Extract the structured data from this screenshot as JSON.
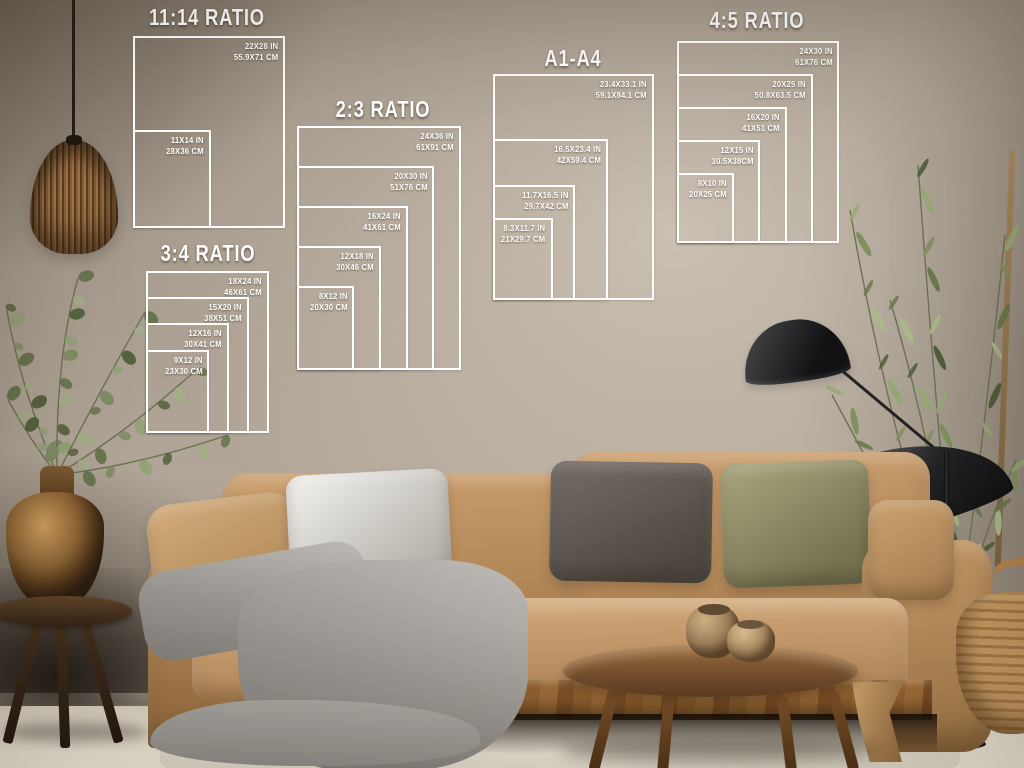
{
  "panels": [
    {
      "id": "ratio-11-14",
      "title": "11:14 RATIO",
      "sizes": [
        {
          "in_label": "22X28 IN",
          "cm_label": "55.9X71 CM",
          "w_in": 22,
          "h_in": 28
        },
        {
          "in_label": "11X14 IN",
          "cm_label": "28X36 CM",
          "w_in": 11,
          "h_in": 14
        }
      ]
    },
    {
      "id": "ratio-2-3",
      "title": "2:3 RATIO",
      "sizes": [
        {
          "in_label": "24X36 IN",
          "cm_label": "61X91 CM",
          "w_in": 24,
          "h_in": 36
        },
        {
          "in_label": "20X30 IN",
          "cm_label": "51X76 CM",
          "w_in": 20,
          "h_in": 30
        },
        {
          "in_label": "16X24 IN",
          "cm_label": "41X61 CM",
          "w_in": 16,
          "h_in": 24
        },
        {
          "in_label": "12X18 IN",
          "cm_label": "30X46 CM",
          "w_in": 12,
          "h_in": 18
        },
        {
          "in_label": "8X12 IN",
          "cm_label": "20X30 CM",
          "w_in": 8,
          "h_in": 12
        }
      ]
    },
    {
      "id": "a1-a4",
      "title": "A1-A4",
      "sizes": [
        {
          "in_label": "23.4X33.1 IN",
          "cm_label": "59.1X84.1 CM",
          "w_in": 23.4,
          "h_in": 33.1
        },
        {
          "in_label": "16.5X23.4 IN",
          "cm_label": "42X59.4 CM",
          "w_in": 16.5,
          "h_in": 23.4
        },
        {
          "in_label": "11.7X16.5 IN",
          "cm_label": "29.7X42 CM",
          "w_in": 11.7,
          "h_in": 16.5
        },
        {
          "in_label": "8.3X11.7 IN",
          "cm_label": "21X29.7 CM",
          "w_in": 8.3,
          "h_in": 11.7
        }
      ]
    },
    {
      "id": "ratio-4-5",
      "title": "4:5 RATIO",
      "sizes": [
        {
          "in_label": "24X30 IN",
          "cm_label": "61X76 CM",
          "w_in": 24,
          "h_in": 30
        },
        {
          "in_label": "20X25 IN",
          "cm_label": "50.8X63.5 CM",
          "w_in": 20,
          "h_in": 25
        },
        {
          "in_label": "16X20 IN",
          "cm_label": "41X51 CM",
          "w_in": 16,
          "h_in": 20
        },
        {
          "in_label": "12X15 IN",
          "cm_label": "30.5X38CM",
          "w_in": 12,
          "h_in": 15
        },
        {
          "in_label": "8X10 IN",
          "cm_label": "20X25 CM",
          "w_in": 8,
          "h_in": 10
        }
      ]
    },
    {
      "id": "ratio-3-4",
      "title": "3:4 RATIO",
      "sizes": [
        {
          "in_label": "18X24 IN",
          "cm_label": "46X61 CM",
          "w_in": 18,
          "h_in": 24
        },
        {
          "in_label": "15X20 IN",
          "cm_label": "38X51 CM",
          "w_in": 15,
          "h_in": 20
        },
        {
          "in_label": "12X16 IN",
          "cm_label": "30X41 CM",
          "w_in": 12,
          "h_in": 16
        },
        {
          "in_label": "9X12 IN",
          "cm_label": "23X30 CM",
          "w_in": 9,
          "h_in": 12
        }
      ]
    }
  ],
  "colors": {
    "diagram_line": "#ffffff",
    "wall": "#a89d8f",
    "sofa": "#b98d5c",
    "wood": "#7c5430",
    "blanket": "#96938e"
  }
}
